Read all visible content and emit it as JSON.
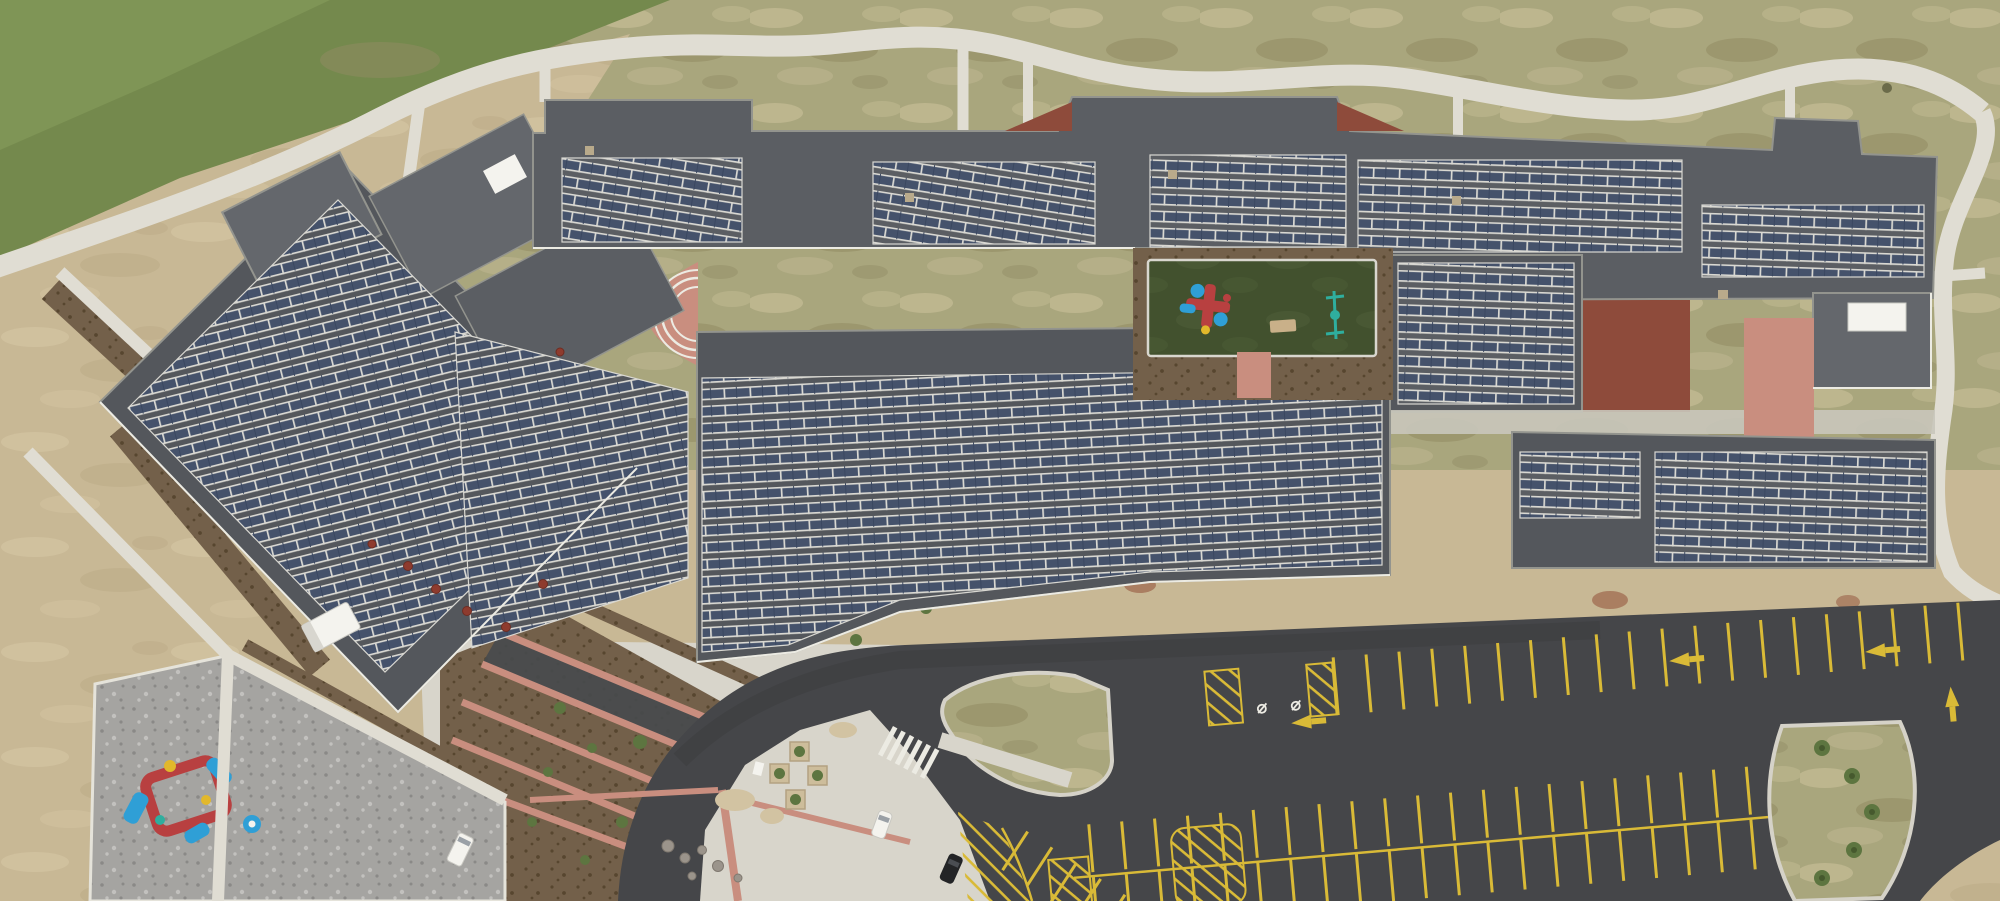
{
  "meta": {
    "title": "Aerial drone photograph of a school campus with rooftop solar panel arrays",
    "type": "aerial-photograph",
    "width_px": 2000,
    "height_px": 901
  },
  "palette": {
    "dirt": "#c8b895",
    "dirtLight": "#d6c8a6",
    "dirtDark": "#b3a27d",
    "grassBright": "#74894d",
    "grassVivid": "#7f9556",
    "grassOlive": "#a9a67d",
    "grassTan": "#c4bb94",
    "grassDark": "#918b63",
    "sidewalk": "#e0ddd3",
    "concrete": "#d8d5cb",
    "concreteDim": "#c9c6bb",
    "roof": "#54575c",
    "roofMid": "#5b5e63",
    "roofLight": "#64676c",
    "parapet": "#93948e",
    "panel": "#45526b",
    "panelDark": "#3a4760",
    "rail": "#d9d8d2",
    "asphalt": "#454649",
    "asphaltDark": "#3b3c3e",
    "yellow": "#d9ba37",
    "lineWhite": "#ecebe3",
    "turf": "#42512e",
    "turfLight": "#50603a",
    "mulch": "#73604a",
    "mulchDark": "#57462f",
    "pink": "#c98e7f",
    "pinkDeep": "#b97b6c",
    "terracotta": "#8e4b3b",
    "gravel": "#a5a4a1",
    "gravelDark": "#8a8987",
    "gravelLight": "#c2c1be",
    "playRed": "#b84040",
    "playBlue": "#2f9fd6",
    "playYellow": "#e2b82b",
    "playTeal": "#2fae9e",
    "treeGreen": "#5d7540",
    "treeDark": "#46592e",
    "white": "#f4f3ee",
    "black": "#232426",
    "redVent": "#8e3b2e",
    "redDirt": "#96573f",
    "sand": "#d2c3a2",
    "boulder": "#9b948b",
    "shadow": "#34363a"
  },
  "scene": {
    "setting": "Top-down aerial view of a new single-story school. Flat dark-gray roofs are covered with rows of blue solar panels on white racking. A green turf courtyard with play equipment sits in the middle of the building. A curving asphalt drive and freshly striped parking lot occupy the lower right; a gravel playground with a red-and-blue play structure sits lower left. Green lawn fades to bare tan dirt around the site, with a winding white sidewalk along the top.",
    "areas": [
      {
        "name": "grass-field-northwest",
        "description": "Irrigated green lawn in the top-left corner"
      },
      {
        "name": "patchy-grass-band",
        "description": "Patchy olive/tan grass strip along the north and east of the building"
      },
      {
        "name": "bare-dirt-west",
        "description": "Bare tan dirt ground on the left side of the site"
      },
      {
        "name": "winding-sidewalk",
        "description": "White concrete path winding along the top with spur connections to the building"
      },
      {
        "name": "school-building",
        "description": "Connected school wings with dark flat roofs and parapets"
      },
      {
        "name": "solar-arrays",
        "description": "Ten-plus zones of blue PV modules in rows on white racking"
      },
      {
        "name": "turf-courtyard",
        "description": "Dark green artificial-turf play court with playground structure, bench and swing set"
      },
      {
        "name": "terracotta-courtyard",
        "description": "Second courtyard with red-brown patio, grass strip and pink walkway"
      },
      {
        "name": "amphitheater",
        "description": "Pink half-round plaza with white curved steps in the west courtyard"
      },
      {
        "name": "entry-terraces",
        "description": "Terraced planting beds with pink curbs and young shrubs at the main entrance"
      },
      {
        "name": "entry-plaza",
        "description": "Light concrete plaza with pink accent bands, square planters, boulders and sand piles"
      },
      {
        "name": "gravel-playground",
        "description": "Gray pea-gravel playground with red/blue climbing structure and blue spinner"
      },
      {
        "name": "bus-loop-road",
        "description": "Dark asphalt drive curving from the bottom edge around to the east"
      },
      {
        "name": "parking-lot",
        "description": "New asphalt lot with yellow stalls, crosshatch no-park zones, handicap stalls and lane arrows"
      },
      {
        "name": "crosswalk",
        "description": "White-striped pedestrian crossing over the entry drive"
      },
      {
        "name": "grass-islands",
        "description": "Curbed landscape islands in the lot, one planted with small trees"
      },
      {
        "name": "dirt-southeast-corner",
        "description": "Bare dirt at the extreme bottom-right corner"
      }
    ],
    "vehicles": [
      {
        "name": "white-box-truck",
        "location": "parked against the west wing wall"
      },
      {
        "name": "white-van",
        "location": "service walk east of the gravel playground"
      },
      {
        "name": "white-car",
        "location": "concrete apron at the bus loop"
      },
      {
        "name": "black-car",
        "location": "entry drive curb"
      }
    ],
    "parking": {
      "stall_line_color": "#d9ba37",
      "features": [
        "handicap symbols",
        "crosshatched no-parking zones",
        "left-turn lane arrows",
        "up arrow at exit",
        "angled stalls at west end"
      ]
    },
    "solar": {
      "array_zones": 11,
      "panel_color": "#45526b",
      "racking_color": "#d9d8d2"
    }
  }
}
